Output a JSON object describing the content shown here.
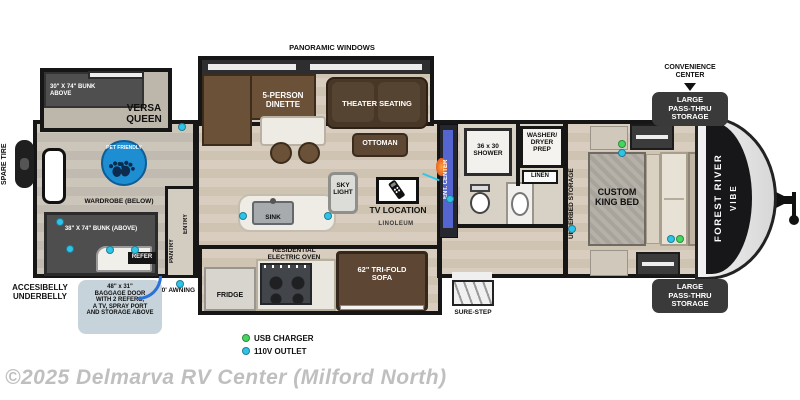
{
  "colors": {
    "outlet_110v": "#2ec4e8",
    "usb_charger": "#45d65f",
    "pet_badge": "#1d8ed2",
    "label_bg": "#3a3a3a",
    "callout_bg": "#c7d3da",
    "door_swing": "#2a72d8"
  },
  "labels": {
    "spare_tire": "SPARE TIRE",
    "bunk_top": "30\" X 74\" BUNK\nABOVE",
    "versa_queen": "VERSA\nQUEEN",
    "pet_friendly": "PET FRIENDLY",
    "wardrobe_below": "WARDROBE (BELOW)",
    "bunk_bottom": "38\" X 74\" BUNK (ABOVE)",
    "refer": "REFER",
    "underbelly": "ACCESIBELLY\nUNDERBELLY",
    "baggage_door": "48\" x 31\"\nBAGGAGE DOOR\nWITH 2 REFERS,\nA TV, SPRAY PORT\nAND STORAGE ABOVE",
    "awning": "20' AWNING",
    "pantry": "PANTRY",
    "entry": "ENTRY",
    "panoramic_windows": "PANORAMIC WINDOWS",
    "dinette": "5-PERSON\nDINETTE",
    "theater_seating": "THEATER SEATING",
    "ottoman": "OTTOMAN",
    "sink": "SINK",
    "sky_light": "SKY\nLIGHT",
    "tv_location": "TV LOCATION",
    "linoleum": "LINOLEUM",
    "oven": "RESIDENTIAL\nELECTRIC OVEN",
    "fridge": "FRIDGE",
    "sofa": "62\" TRI-FOLD\nSOFA",
    "sure_step": "SURE-STEP",
    "ent_center": "ENT. CENTER",
    "shower": "36 x 30\nSHOWER",
    "washer_dryer": "WASHER/\nDRYER\nPREP",
    "linen": "LINEN",
    "underbed_storage": "UNDERBED STORAGE",
    "king_bed": "CUSTOM\nKING BED",
    "brand_line1": "FOREST RIVER",
    "brand_line2": "VIBE",
    "convenience_center": "CONVENIENCE\nCENTER",
    "pass_thru": "LARGE\nPASS-THRU\nSTORAGE"
  },
  "legend": {
    "usb": "USB CHARGER",
    "outlet": "110V OUTLET"
  },
  "footer": {
    "copyright": "©2025 Delmarva RV Center (Milford North)"
  },
  "outlets_110v": [
    [
      60,
      222
    ],
    [
      70,
      249
    ],
    [
      110,
      250
    ],
    [
      135,
      250
    ],
    [
      182,
      127
    ],
    [
      180,
      284
    ],
    [
      243,
      216
    ],
    [
      328,
      216
    ],
    [
      450,
      199
    ],
    [
      572,
      229
    ],
    [
      622,
      153
    ],
    [
      671,
      239
    ]
  ],
  "usb_chargers": [
    [
      622,
      144
    ],
    [
      680,
      239
    ]
  ]
}
